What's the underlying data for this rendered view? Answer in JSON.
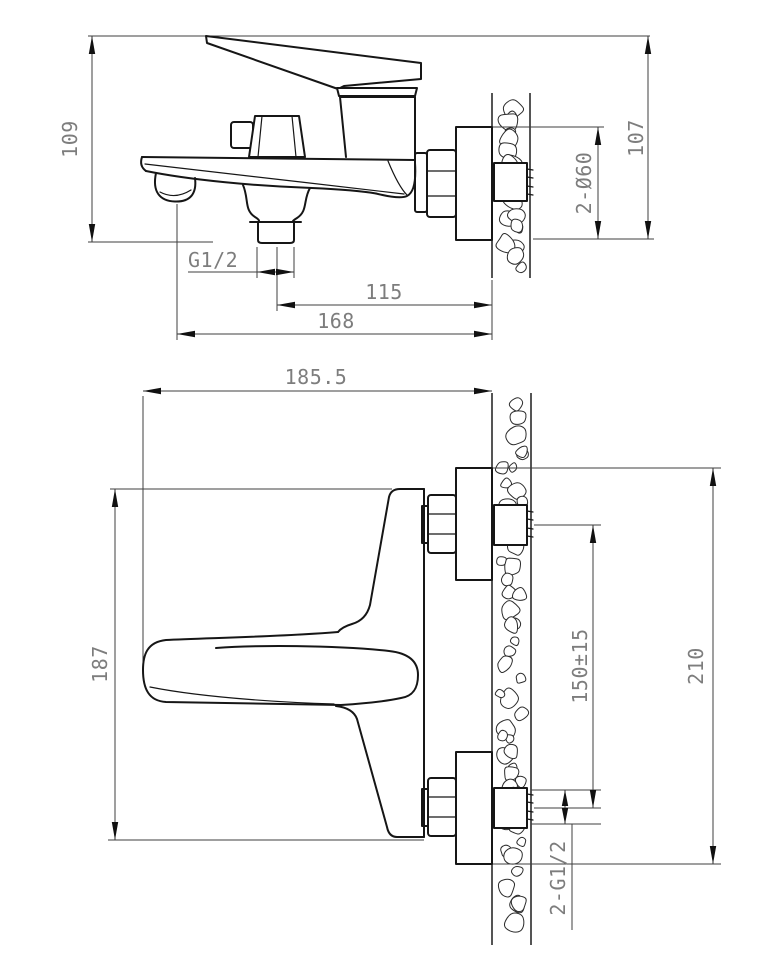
{
  "drawing": {
    "colors": {
      "object_line": "#161616",
      "dimension_line": "#3f3f3f",
      "label": "#7d7d7d",
      "background": "#ffffff"
    },
    "side_view": {
      "overall_height": "109",
      "height_at_wall": "107",
      "flange_diameter": "2-Ø60",
      "outlet_thread": "G1/2",
      "tail_to_wall": "115",
      "spout_reach": "168"
    },
    "plan_view": {
      "projection": "185.5",
      "body_width": "187",
      "inlet_spacing": "150±15",
      "overall_span": "210",
      "inlet_thread": "2-G1/2"
    }
  }
}
